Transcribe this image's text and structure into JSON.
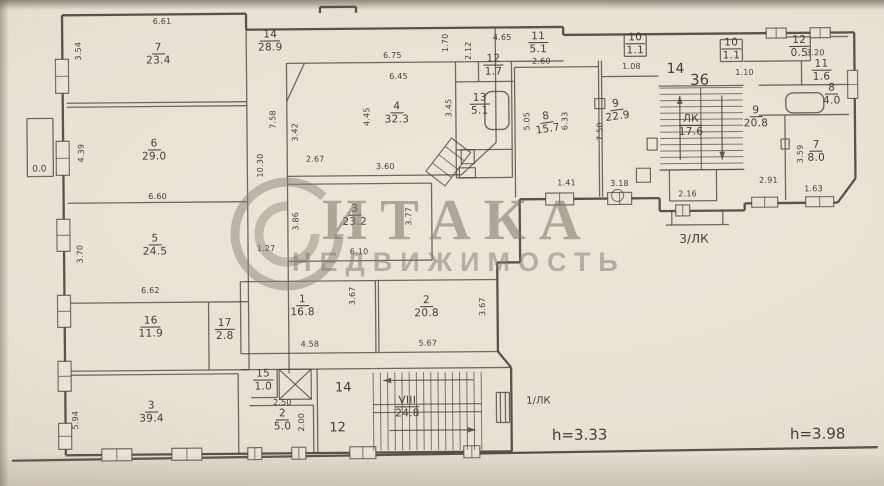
{
  "watermark": {
    "brand": "ИТАКА",
    "subtitle": "НЕДВИЖИМОСТЬ"
  },
  "annotations": {
    "stair_left": "1/ЛК",
    "stair_right": "3/ЛК",
    "height_left": "h=3.33",
    "height_right": "h=3.98"
  },
  "plan": {
    "stroke": "#4f473d",
    "paper": "#e9e2d5",
    "rooms": [
      {
        "num": "7",
        "area": "23.4",
        "x": 160,
        "y": 52
      },
      {
        "num": "6",
        "area": "29.0",
        "x": 155,
        "y": 148
      },
      {
        "num": "5",
        "area": "24.5",
        "x": 155,
        "y": 243
      },
      {
        "num": "16",
        "area": "11.9",
        "x": 150,
        "y": 325
      },
      {
        "num": "17",
        "area": "2.8",
        "x": 224,
        "y": 328
      },
      {
        "num": "3",
        "area": "39.4",
        "x": 150,
        "y": 410
      },
      {
        "num": "14",
        "area": "28.9",
        "x": 272,
        "y": 40
      },
      {
        "num": "4",
        "area": "32.3",
        "x": 398,
        "y": 113
      },
      {
        "num": "3",
        "area": "23.2",
        "x": 355,
        "y": 215
      },
      {
        "num": "1",
        "area": "16.8",
        "x": 302,
        "y": 305
      },
      {
        "num": "2",
        "area": "20.8",
        "x": 426,
        "y": 307
      },
      {
        "num": "15",
        "area": "1.0",
        "x": 262,
        "y": 379
      },
      {
        "num": "2",
        "area": "5.0",
        "x": 281,
        "y": 419
      },
      {
        "num": "13",
        "area": "5.1",
        "x": 481,
        "y": 105
      },
      {
        "num": "12",
        "area": "1.7",
        "x": 495,
        "y": 66
      },
      {
        "num": "11",
        "area": "5.1",
        "x": 540,
        "y": 44
      },
      {
        "num": "10",
        "area": "1.1",
        "x": 637,
        "y": 46
      },
      {
        "num": "8",
        "area": "15.7",
        "x": 548,
        "y": 124,
        "rot": -8
      },
      {
        "num": "9",
        "area": "22.9",
        "x": 618,
        "y": 112,
        "rot": -8
      },
      {
        "num": "VIII",
        "area": "24.8",
        "x": 406,
        "y": 407
      },
      {
        "num": "ЛК",
        "area": "17.6",
        "x": 692,
        "y": 128
      },
      {
        "num": "10",
        "area": "1.1",
        "x": 733,
        "y": 52
      },
      {
        "num": "12",
        "area": "0.5",
        "x": 801,
        "y": 50
      },
      {
        "num": "11",
        "area": "1.6",
        "x": 823,
        "y": 74
      },
      {
        "num": "8",
        "area": "4.0",
        "x": 833,
        "y": 98
      },
      {
        "num": "9",
        "area": "20.8",
        "x": 757,
        "y": 120
      },
      {
        "num": "7",
        "area": "8.0",
        "x": 817,
        "y": 155
      }
    ],
    "dims": [
      [
        "6.61",
        164,
        19,
        0
      ],
      [
        "3.54",
        80,
        48,
        1
      ],
      [
        "4.39",
        82,
        150,
        1
      ],
      [
        "6.60",
        158,
        194,
        0
      ],
      [
        "3.70",
        80,
        251,
        1
      ],
      [
        "6.62",
        150,
        288,
        0
      ],
      [
        "5.94",
        74,
        417,
        1
      ],
      [
        "10.30",
        261,
        164,
        1
      ],
      [
        "7.58",
        274,
        118,
        1
      ],
      [
        "3.42",
        296,
        131,
        1
      ],
      [
        "2.67",
        316,
        158,
        0
      ],
      [
        "3.60",
        386,
        166,
        0
      ],
      [
        "3.86",
        296,
        220,
        1
      ],
      [
        "1.27",
        266,
        247,
        0
      ],
      [
        "6.10",
        359,
        251,
        0
      ],
      [
        "3.77",
        409,
        216,
        1
      ],
      [
        "6.75",
        394,
        55,
        0
      ],
      [
        "6.45",
        400,
        76,
        0
      ],
      [
        "4.45",
        368,
        116,
        1
      ],
      [
        "3.45",
        450,
        108,
        1
      ],
      [
        "1.70",
        447,
        43,
        1
      ],
      [
        "2.12",
        470,
        51,
        1
      ],
      [
        "4.65",
        504,
        38,
        0
      ],
      [
        "2.60",
        543,
        62,
        0
      ],
      [
        "5.05",
        528,
        122,
        1
      ],
      [
        "6.33",
        566,
        122,
        1
      ],
      [
        "1.41",
        567,
        184,
        0
      ],
      [
        "1.08",
        633,
        68,
        0
      ],
      [
        "7.50",
        601,
        133,
        1
      ],
      [
        "3.18",
        620,
        185,
        0
      ],
      [
        "2.16",
        688,
        196,
        0
      ],
      [
        "1.10",
        746,
        75,
        0
      ],
      [
        "3.20",
        817,
        56,
        0
      ],
      [
        "2.91",
        769,
        183,
        0
      ],
      [
        "3.59",
        801,
        157,
        1
      ],
      [
        "1.63",
        814,
        192,
        0
      ],
      [
        "3.67",
        352,
        295,
        1
      ],
      [
        "4.58",
        309,
        343,
        0
      ],
      [
        "5.67",
        427,
        343,
        0
      ],
      [
        "3.67",
        482,
        307,
        1
      ],
      [
        "2.50",
        281,
        401,
        0
      ],
      [
        "2.00",
        300,
        421,
        1
      ]
    ],
    "texts": [
      [
        "1/ЛК",
        537,
        402,
        10
      ],
      [
        "h=3.33",
        578,
        436,
        15
      ],
      [
        "h=3.98",
        816,
        437,
        15
      ],
      [
        "3/ЛК",
        694,
        241,
        12
      ],
      [
        "0.0",
        40,
        166,
        9
      ],
      [
        "14",
        342,
        387,
        13
      ],
      [
        "12",
        336,
        427,
        13
      ],
      [
        "14",
        677,
        71,
        14
      ],
      [
        "36",
        701,
        82,
        15
      ]
    ],
    "walls": [
      [
        64,
        12,
        248,
        12
      ],
      [
        248,
        12,
        248,
        28
      ],
      [
        248,
        28,
        565,
        28
      ],
      [
        565,
        28,
        565,
        36
      ],
      [
        565,
        36,
        856,
        36
      ],
      [
        856,
        36,
        856,
        182
      ],
      [
        856,
        182,
        838,
        206
      ],
      [
        838,
        206,
        745,
        206
      ],
      [
        745,
        206,
        745,
        213
      ],
      [
        745,
        213,
        660,
        213
      ],
      [
        660,
        213,
        660,
        200
      ],
      [
        660,
        200,
        520,
        200
      ],
      [
        520,
        200,
        520,
        263
      ],
      [
        520,
        263,
        497,
        263
      ],
      [
        497,
        263,
        497,
        352
      ],
      [
        497,
        352,
        510,
        368
      ],
      [
        510,
        368,
        510,
        452
      ],
      [
        510,
        452,
        64,
        452
      ],
      [
        64,
        452,
        64,
        12
      ],
      [
        322,
        6,
        358,
        6
      ],
      [
        322,
        12,
        322,
        6
      ],
      [
        358,
        12,
        358,
        6
      ],
      [
        10,
        457,
        876,
        451
      ]
    ],
    "thin": [
      [
        68,
        100,
        248,
        100
      ],
      [
        68,
        104,
        248,
        104
      ],
      [
        68,
        200,
        248,
        200
      ],
      [
        68,
        300,
        248,
        300
      ],
      [
        208,
        300,
        208,
        368
      ],
      [
        68,
        368,
        248,
        368
      ],
      [
        64,
        372,
        237,
        372
      ],
      [
        237,
        372,
        237,
        452
      ],
      [
        248,
        28,
        248,
        368
      ],
      [
        288,
        62,
        288,
        372
      ],
      [
        288,
        62,
        565,
        62
      ],
      [
        288,
        100,
        306,
        62
      ],
      [
        288,
        175,
        462,
        175
      ],
      [
        462,
        175,
        497,
        143
      ],
      [
        497,
        62,
        497,
        143
      ],
      [
        288,
        183,
        432,
        183
      ],
      [
        432,
        183,
        432,
        260
      ],
      [
        288,
        260,
        432,
        260
      ],
      [
        240,
        280,
        497,
        280
      ],
      [
        240,
        280,
        240,
        352
      ],
      [
        240,
        352,
        497,
        352
      ],
      [
        375,
        280,
        375,
        352
      ],
      [
        378,
        280,
        378,
        352
      ],
      [
        240,
        368,
        510,
        368
      ],
      [
        316,
        368,
        316,
        452
      ],
      [
        276,
        368,
        276,
        396
      ],
      [
        250,
        396,
        276,
        396
      ],
      [
        248,
        404,
        312,
        404
      ],
      [
        312,
        404,
        312,
        452
      ],
      [
        516,
        68,
        600,
        68
      ],
      [
        516,
        68,
        516,
        198
      ],
      [
        600,
        62,
        600,
        198
      ],
      [
        603,
        62,
        603,
        198
      ],
      [
        603,
        78,
        660,
        78
      ],
      [
        497,
        28,
        497,
        62
      ],
      [
        480,
        62,
        480,
        82
      ],
      [
        457,
        62,
        457,
        178
      ],
      [
        457,
        82,
        515,
        82
      ],
      [
        513,
        62,
        513,
        150
      ],
      [
        457,
        150,
        513,
        150
      ],
      [
        457,
        178,
        513,
        178
      ],
      [
        513,
        150,
        513,
        178
      ],
      [
        626,
        36,
        648,
        36
      ],
      [
        626,
        36,
        626,
        58
      ],
      [
        648,
        36,
        648,
        58
      ],
      [
        626,
        58,
        648,
        58
      ],
      [
        722,
        42,
        744,
        42
      ],
      [
        722,
        42,
        722,
        64
      ],
      [
        744,
        42,
        744,
        64
      ],
      [
        722,
        64,
        744,
        64
      ],
      [
        745,
        64,
        812,
        64
      ],
      [
        786,
        118,
        786,
        203
      ],
      [
        760,
        88,
        850,
        88
      ],
      [
        760,
        118,
        850,
        118
      ],
      [
        803,
        64,
        803,
        88
      ],
      [
        788,
        40,
        850,
        40
      ],
      [
        812,
        40,
        812,
        64
      ],
      [
        660,
        88,
        745,
        88
      ],
      [
        660,
        172,
        745,
        172
      ],
      [
        670,
        172,
        670,
        203
      ],
      [
        717,
        172,
        717,
        203
      ],
      [
        670,
        203,
        717,
        203
      ],
      [
        672,
        213,
        672,
        227
      ],
      [
        723,
        213,
        723,
        227
      ],
      [
        666,
        227,
        729,
        227
      ],
      [
        28,
        115,
        54,
        115
      ],
      [
        28,
        115,
        28,
        173
      ],
      [
        54,
        115,
        54,
        173
      ],
      [
        28,
        173,
        54,
        173
      ],
      [
        495,
        393,
        508,
        393
      ],
      [
        495,
        393,
        495,
        423
      ],
      [
        508,
        393,
        508,
        423
      ],
      [
        495,
        423,
        508,
        423
      ],
      [
        499,
        393,
        499,
        423
      ],
      [
        504,
        393,
        504,
        423
      ]
    ],
    "windows": [
      {
        "x": 57,
        "y": 56,
        "w": 13,
        "h": 34,
        "v": 1
      },
      {
        "x": 57,
        "y": 138,
        "w": 13,
        "h": 34,
        "v": 1
      },
      {
        "x": 57,
        "y": 216,
        "w": 13,
        "h": 32,
        "v": 1
      },
      {
        "x": 57,
        "y": 292,
        "w": 13,
        "h": 32,
        "v": 1
      },
      {
        "x": 57,
        "y": 358,
        "w": 13,
        "h": 30,
        "v": 1
      },
      {
        "x": 57,
        "y": 420,
        "w": 13,
        "h": 26,
        "v": 1
      },
      {
        "x": 100,
        "y": 446,
        "w": 30,
        "h": 12,
        "v": 0
      },
      {
        "x": 170,
        "y": 446,
        "w": 30,
        "h": 12,
        "v": 0
      },
      {
        "x": 246,
        "y": 446,
        "w": 14,
        "h": 12,
        "v": 0
      },
      {
        "x": 290,
        "y": 446,
        "w": 14,
        "h": 12,
        "v": 0
      },
      {
        "x": 348,
        "y": 446,
        "w": 26,
        "h": 12,
        "v": 0
      },
      {
        "x": 462,
        "y": 446,
        "w": 16,
        "h": 12,
        "v": 0
      },
      {
        "x": 546,
        "y": 194,
        "w": 28,
        "h": 12,
        "v": 0
      },
      {
        "x": 608,
        "y": 194,
        "w": 24,
        "h": 12,
        "v": 0
      },
      {
        "x": 676,
        "y": 207,
        "w": 14,
        "h": 11,
        "v": 0
      },
      {
        "x": 752,
        "y": 200,
        "w": 26,
        "h": 10,
        "v": 0
      },
      {
        "x": 806,
        "y": 200,
        "w": 28,
        "h": 10,
        "v": 0
      },
      {
        "x": 849,
        "y": 74,
        "w": 10,
        "h": 28,
        "v": 1
      },
      {
        "x": 768,
        "y": 31,
        "w": 20,
        "h": 10,
        "v": 0
      },
      {
        "x": 812,
        "y": 31,
        "w": 20,
        "h": 10,
        "v": 0
      }
    ],
    "stairs": [
      {
        "x": 372,
        "y": 372,
        "w": 108,
        "h": 78,
        "dir": "v",
        "step": 7.2,
        "bands": [
          404,
          412
        ]
      },
      {
        "x": 661,
        "y": 90,
        "w": 83,
        "h": 82,
        "dir": "h",
        "step": 6.3,
        "bands": [
          702
        ]
      }
    ],
    "arrows": [
      [
        472,
        380,
        382,
        380
      ],
      [
        388,
        430,
        474,
        430
      ],
      [
        681,
        162,
        681,
        98
      ],
      [
        723,
        98,
        723,
        162
      ]
    ],
    "xboxes": [
      {
        "x": 278,
        "y": 368,
        "w": 32,
        "h": 30
      }
    ],
    "baths": [
      {
        "x": 486,
        "y": 92,
        "w": 24,
        "h": 38
      },
      {
        "x": 787,
        "y": 96,
        "w": 38,
        "h": 20
      }
    ],
    "fixtures": [
      {
        "x": 596,
        "y": 100,
        "w": 10,
        "h": 10
      },
      {
        "x": 648,
        "y": 140,
        "w": 10,
        "h": 12
      },
      {
        "x": 637,
        "y": 170,
        "w": 14,
        "h": 14
      },
      {
        "x": 462,
        "y": 150,
        "w": 13,
        "h": 14
      },
      {
        "x": 460,
        "y": 168,
        "w": 16,
        "h": 10
      },
      {
        "x": 782,
        "y": 142,
        "w": 8,
        "h": 10
      }
    ],
    "circles": [
      {
        "x": 618,
        "y": 197,
        "r": 6
      }
    ],
    "diags": [
      {
        "cx": 449,
        "cy": 162,
        "w": 24,
        "h": 42,
        "rot": 38
      }
    ]
  }
}
